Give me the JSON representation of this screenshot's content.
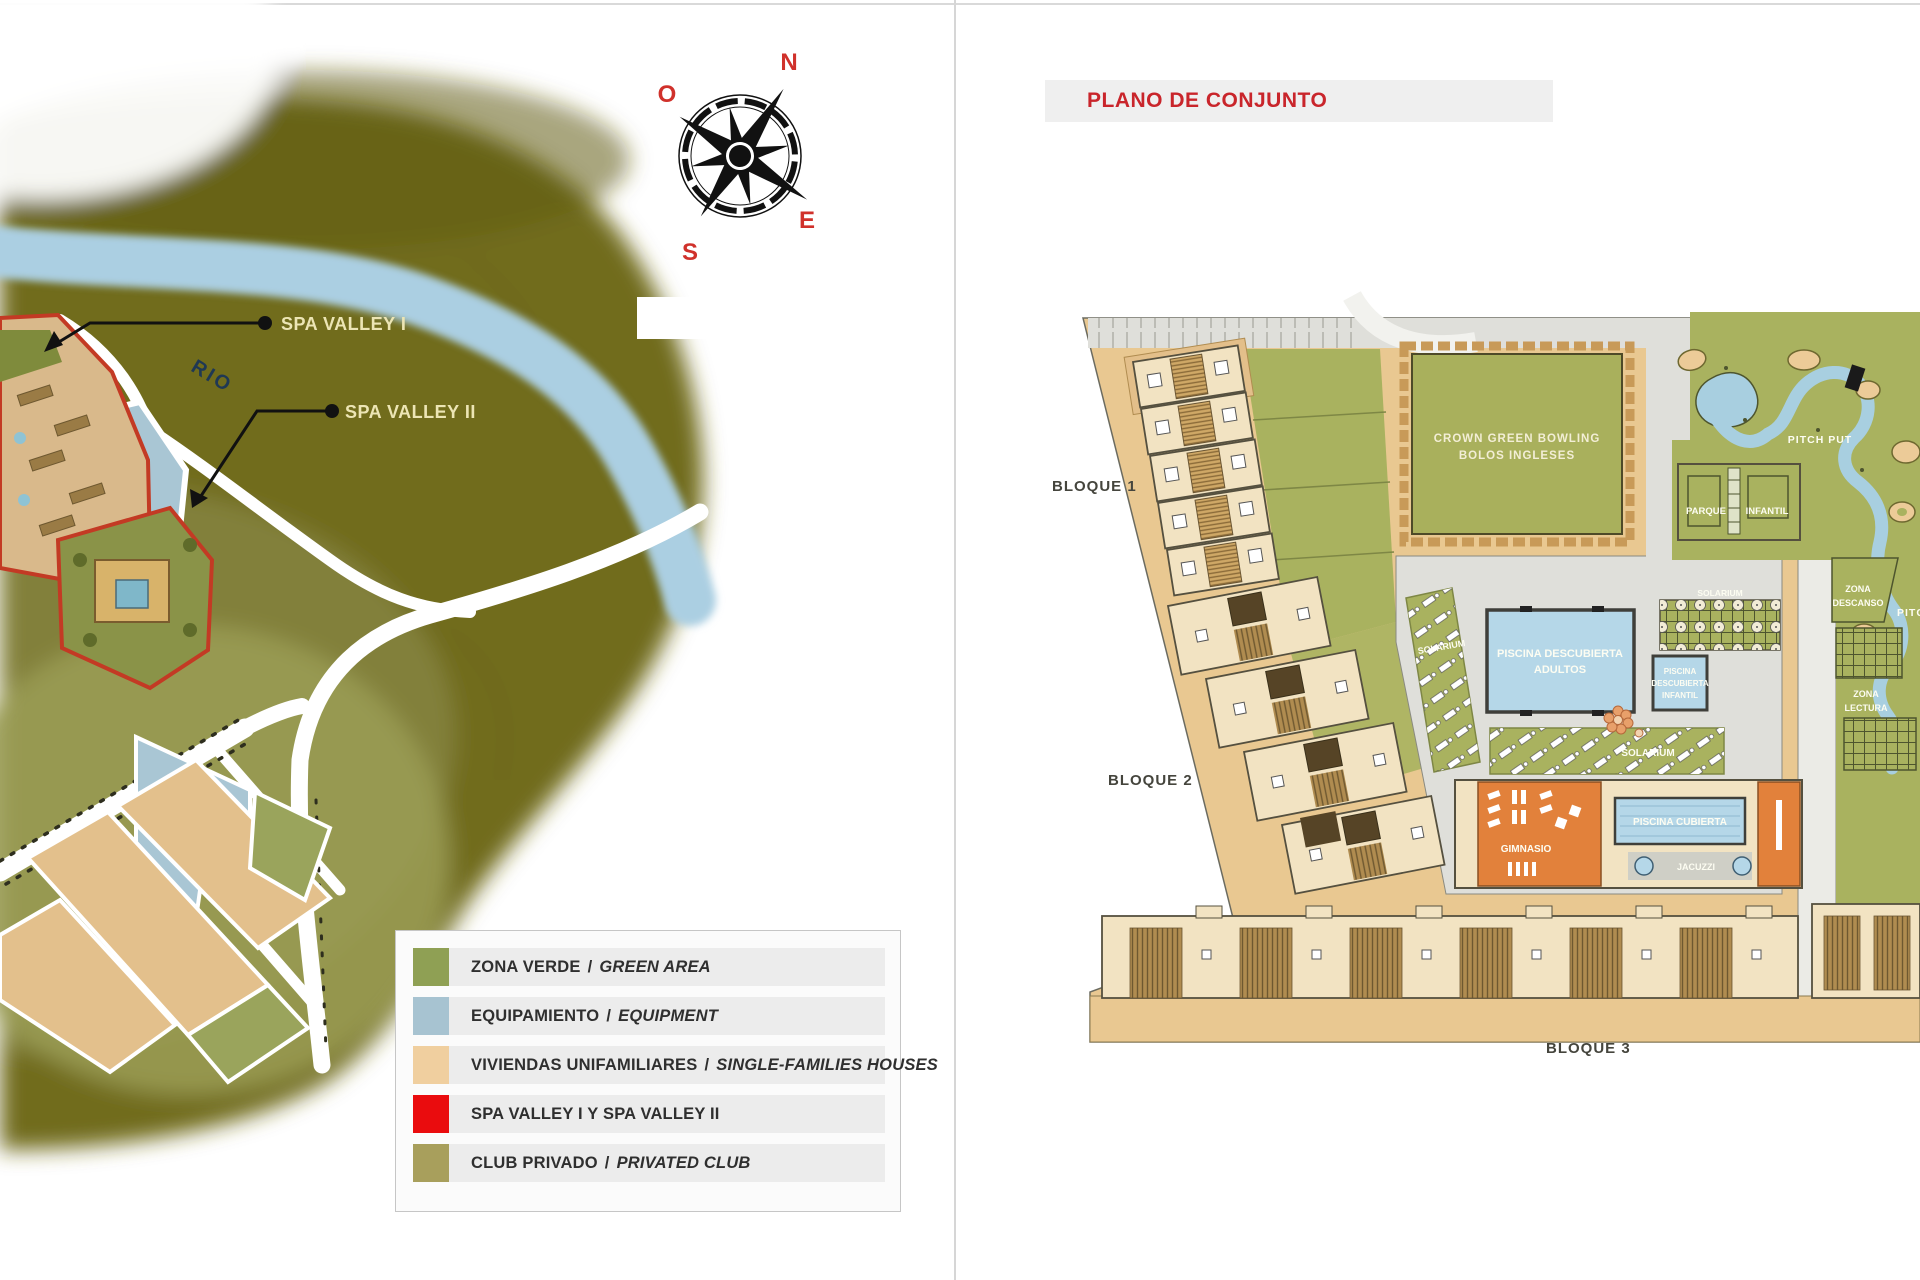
{
  "left_panel": {
    "compass": {
      "north": "N",
      "west": "O",
      "east": "E",
      "south": "S"
    },
    "river_label": "RIO",
    "callout_1": "SPA VALLEY I",
    "callout_2": "SPA VALLEY II",
    "legend": {
      "items": [
        {
          "es": "ZONA VERDE",
          "sep": "/",
          "en": "GREEN AREA",
          "color": "#8fa054"
        },
        {
          "es": "EQUIPAMIENTO",
          "sep": "/",
          "en": "EQUIPMENT",
          "color": "#a7c3d1"
        },
        {
          "es": "VIVIENDAS UNIFAMILIARES",
          "sep": "/",
          "en": "SINGLE-FAMILIES HOUSES",
          "color": "#f0cf9f"
        },
        {
          "es": "SPA VALLEY I Y SPA VALLEY II",
          "sep": "",
          "en": "",
          "color": "#ea0c0e"
        },
        {
          "es": "CLUB PRIVADO",
          "sep": "/",
          "en": "PRIVATED CLUB",
          "color": "#a89f5c"
        }
      ]
    }
  },
  "right_panel": {
    "title": "PLANO DE CONJUNTO",
    "labels": {
      "bowling_1": "CROWN GREEN BOWLING",
      "bowling_2": "BOLOS INGLESES",
      "pitch_put": "PITCH PUT",
      "parque_1": "PARQUE",
      "parque_2": "INFANTIL",
      "zona": "ZONA",
      "descanso": "DESCANSO",
      "lectura": "LECTURA",
      "solarium": "SOLARIUM",
      "piscina_adultos_1": "PISCINA DESCUBIERTA",
      "piscina_adultos_2": "ADULTOS",
      "piscina": "PISCINA",
      "descubierta": "DESCUBIERTA",
      "infantil": "INFANTIL",
      "piscina_cubierta": "PISCINA CUBIERTA",
      "gimnasio": "GIMNASIO",
      "jacuzzi": "JACUZZI",
      "bloque_1": "BLOQUE 1",
      "bloque_2": "BLOQUE 2",
      "bloque_3": "BLOQUE 3"
    }
  },
  "colors": {
    "accent_red": "#c9252b",
    "map_olive": "#716c1e",
    "map_olive_light": "#82803a",
    "river_blue": "#abcfe2",
    "site_tan": "#e9c891",
    "plan_green": "#a9b25f",
    "pool_blue": "#b5d7e8",
    "gym_orange": "#e2813b",
    "path_gray": "#dfdfda"
  }
}
